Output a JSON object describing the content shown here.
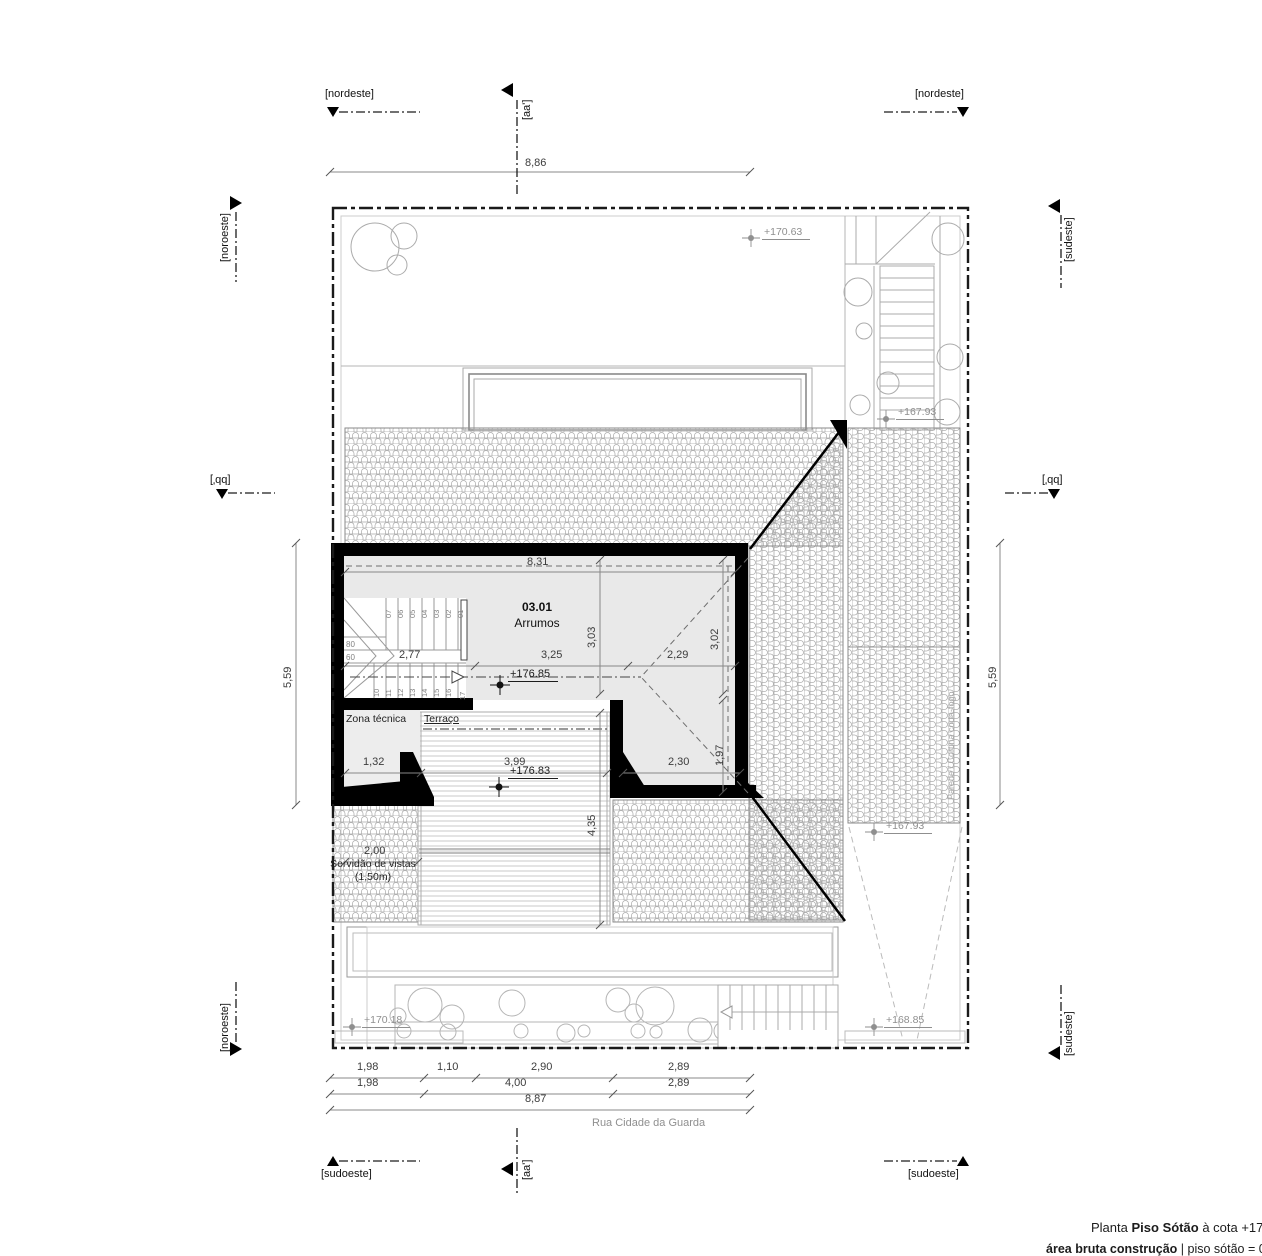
{
  "compass": {
    "nordeste": "[nordeste]",
    "sudoeste": "[sudoeste]",
    "noroeste": "[noroeste]",
    "sudeste": "[sudeste]"
  },
  "sections": {
    "aa": "[aa']",
    "bb": "[bb']"
  },
  "dimensions": {
    "top": "8,86",
    "room_width": "8,31",
    "d303": "3,03",
    "d302": "3,02",
    "d277": "2,77",
    "d325": "3,25",
    "d229": "2,29",
    "d132": "1,32",
    "d399": "3,99",
    "d230": "2,30",
    "d197": "1,97",
    "d435": "4,35",
    "d200": "2,00",
    "left_height": "5,59",
    "right_height": "5,59",
    "bottom_row1": [
      "1,98",
      "1,10",
      "2,90",
      "2,89"
    ],
    "bottom_row2": [
      "1,98",
      "4,00",
      "2,89"
    ],
    "bottom_total": "8,87"
  },
  "levels": {
    "garden": "+170.63",
    "upper_stairs": "+167.93",
    "roof_side": "+167.93",
    "ramp": "+168.85",
    "street": "+170.18",
    "attic": "+176.85",
    "terrace": "+176.83"
  },
  "labels": {
    "room_number": "03.01",
    "room_name": "Arrumos",
    "zona_tecnica": "Zona técnica",
    "terraco": "Terraço",
    "servidao_line1": "Servidão de vistas",
    "servidao_line2": "(1,50m)",
    "firewall": "Parede / Cortina corta-fogo",
    "street_name": "Rua Cidade da Guarda"
  },
  "stairs": {
    "up": [
      "07",
      "06",
      "05",
      "04",
      "03",
      "02",
      "01"
    ],
    "down": [
      "10",
      "11",
      "12",
      "13",
      "14",
      "15",
      "16",
      "17"
    ],
    "w80": "80",
    "w60": "60"
  },
  "title_block": {
    "prefix": "Planta",
    "name": "Piso Sótão",
    "cota": "à cota +178",
    "line2_bold": "área bruta construção",
    "line2_rest": "| piso sótão = 031"
  },
  "colors": {
    "wall": "#000000",
    "hatch": "#a8a8a8",
    "interior": "#e9e9e9",
    "dimension": "#3c3c3c",
    "level": "#8f8f8f"
  }
}
